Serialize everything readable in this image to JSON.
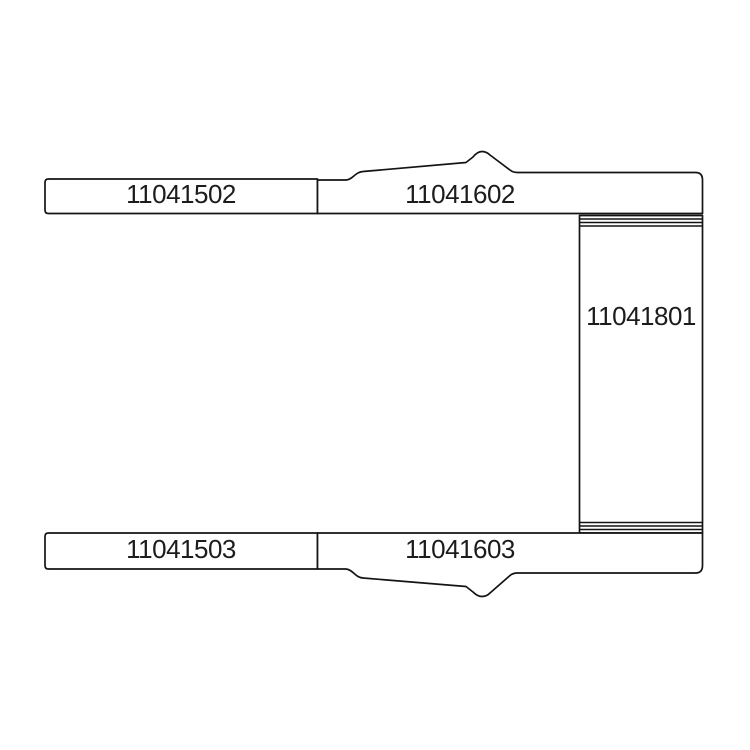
{
  "diagram": {
    "type": "technical-parts-drawing",
    "background_color": "#ffffff",
    "line_color": "#141414",
    "parts": [
      {
        "id": "upper-rail-left",
        "label": "11041502"
      },
      {
        "id": "upper-rail-right",
        "label": "11041602"
      },
      {
        "id": "reinforcement-panel",
        "label": "11041801"
      },
      {
        "id": "lower-rail-left",
        "label": "11041503"
      },
      {
        "id": "lower-rail-right",
        "label": "11041603"
      }
    ]
  }
}
